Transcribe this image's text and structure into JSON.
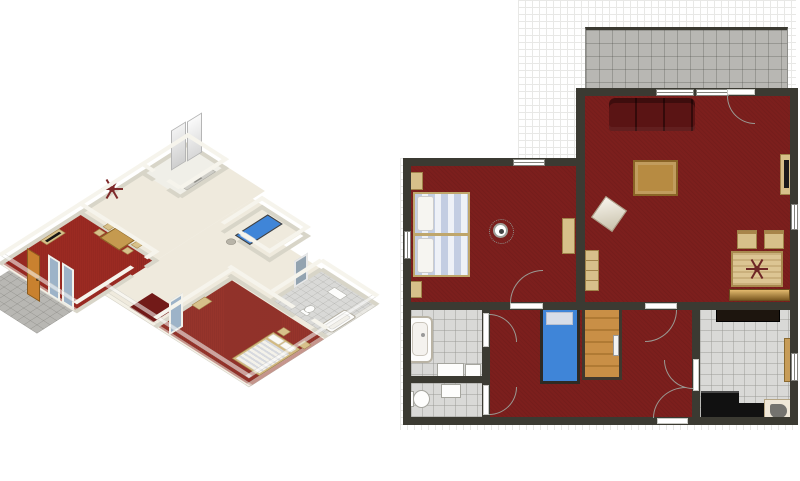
{
  "app": {
    "type": "floor-plan-designer",
    "views": [
      "3d-isometric-view",
      "2d-floor-plan"
    ]
  },
  "iso_view": {
    "label": "3d-isometric-view",
    "rooms": [
      "kitchen",
      "hallway",
      "dining-living-room",
      "master-bedroom",
      "small-bedroom",
      "bathroom",
      "terrace"
    ],
    "furniture": [
      "refrigerator",
      "kitchen-sink-counter",
      "dining-table",
      "dining-chairs",
      "ceiling-chandelier",
      "tv",
      "tv-stand",
      "entrance-door",
      "front-windows",
      "double-bed",
      "pillows",
      "nightstands",
      "dresser",
      "laundry-basket",
      "single-bed-blue",
      "bathtub",
      "toilet",
      "bathroom-vanity",
      "bathroom-mirror",
      "red-rug"
    ]
  },
  "plan_view": {
    "label": "2d-floor-plan",
    "rooms": [
      {
        "name": "terrace",
        "floor": "gray-tile"
      },
      {
        "name": "living-dining-room",
        "floor": "red-carpet"
      },
      {
        "name": "master-bedroom",
        "floor": "red-carpet"
      },
      {
        "name": "hallway",
        "floor": "red-carpet"
      },
      {
        "name": "bathroom",
        "floor": "gray-tile"
      },
      {
        "name": "wc",
        "floor": "gray-tile"
      },
      {
        "name": "kitchen",
        "floor": "gray-tile"
      }
    ],
    "furniture": [
      "sofa",
      "coffee-table",
      "floor-cushion",
      "bookshelf",
      "tv-stand",
      "tv",
      "dining-table",
      "dining-chairs",
      "chandelier",
      "sideboard",
      "double-bed",
      "nightstands",
      "dresser",
      "ceiling-lamp",
      "single-bed",
      "wardrobe",
      "bathtub",
      "bathroom-sinks",
      "toilet",
      "wc-sink",
      "kitchen-counters",
      "kitchen-sink",
      "doors",
      "windows"
    ]
  },
  "colors": {
    "page_bg": "#ffffff",
    "grid_line": "#e8e8e6",
    "wall_dark": "#3b3a32",
    "carpet_red": "#7c1f1d",
    "carpet_red_3d": "#9b2a22",
    "rug_dark_red": "#721a18",
    "floor_cream": "#efeadd",
    "terrace_tile": "#b8b7b3",
    "bath_tile": "#d9d9d7",
    "wood_mid": "#b78b42",
    "wood_light": "#d7c08a",
    "sofa_red": "#5a1414",
    "mattress_stripe": "#c3cde2",
    "bed_blue": "#3f85d8",
    "glass_blue": "#9db3c8",
    "door_orange": "#c9812f",
    "counter_black": "#111111",
    "sink_gray": "#74736f",
    "fixture_white": "#fdfdfc",
    "wall_white_3d": "#f6f4ec",
    "wall_side_3d": "#d8d5c8"
  }
}
